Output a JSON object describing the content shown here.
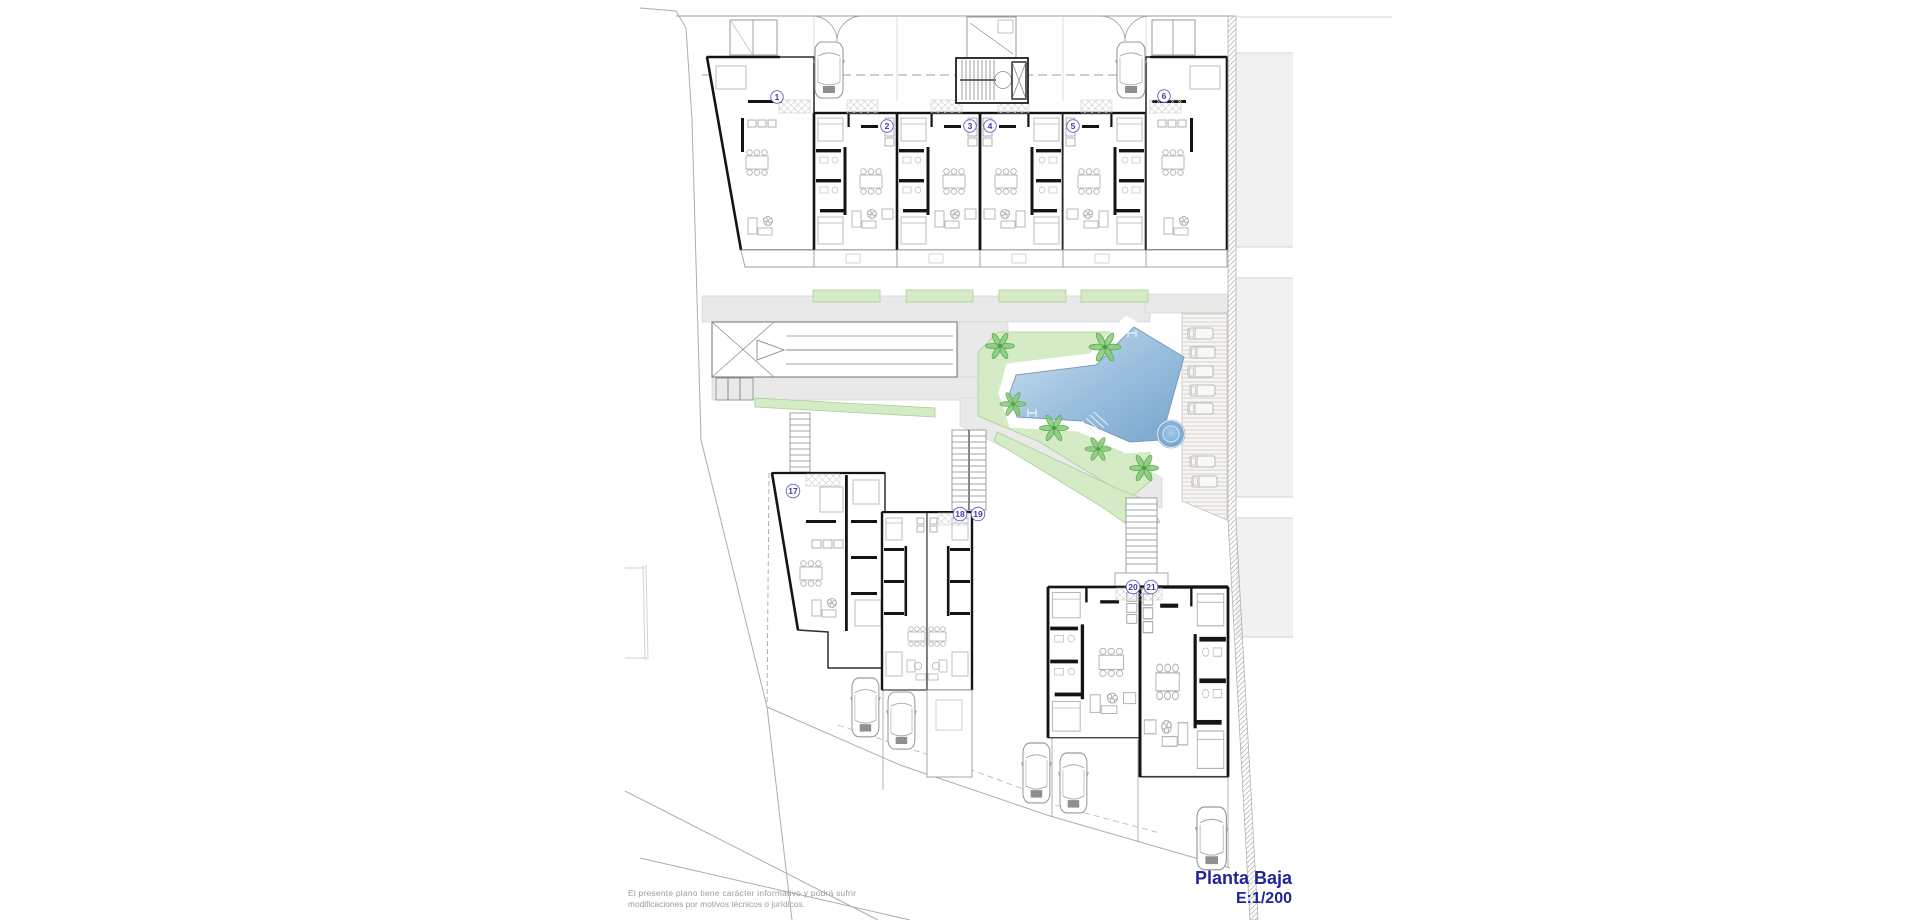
{
  "drawing": {
    "type": "architectural-site-plan",
    "floor_label": "Planta Baja",
    "scale_label": "E:1/200",
    "accent_color": "#23239b"
  },
  "disclaimer": {
    "line1": "El presente plano tiene carácter informativo y podrá sufrir",
    "line2": "modificaciones por motivos técnicos o jurídicos."
  },
  "units": [
    "1",
    "2",
    "3",
    "4",
    "5",
    "6",
    "17",
    "18",
    "19",
    "20",
    "21"
  ],
  "site_features": {
    "pool": "swimming-pool",
    "spa": "circular-spa",
    "sun_deck": "deck-with-loungers",
    "ramp": "parking-ramp",
    "stairs": 3,
    "cars": 7,
    "palm_trees": 6,
    "lounger_count": 7
  },
  "palette": {
    "pool_light": "#c6ddef",
    "pool_dark": "#7fa9cf",
    "green": "#d5ebc5",
    "green_edge": "#a9cf96",
    "path_gray": "#e9e9e9",
    "wall_black": "#141414",
    "annotation_navy": "#23239b",
    "neighbor_gray": "#f1f1f1"
  }
}
